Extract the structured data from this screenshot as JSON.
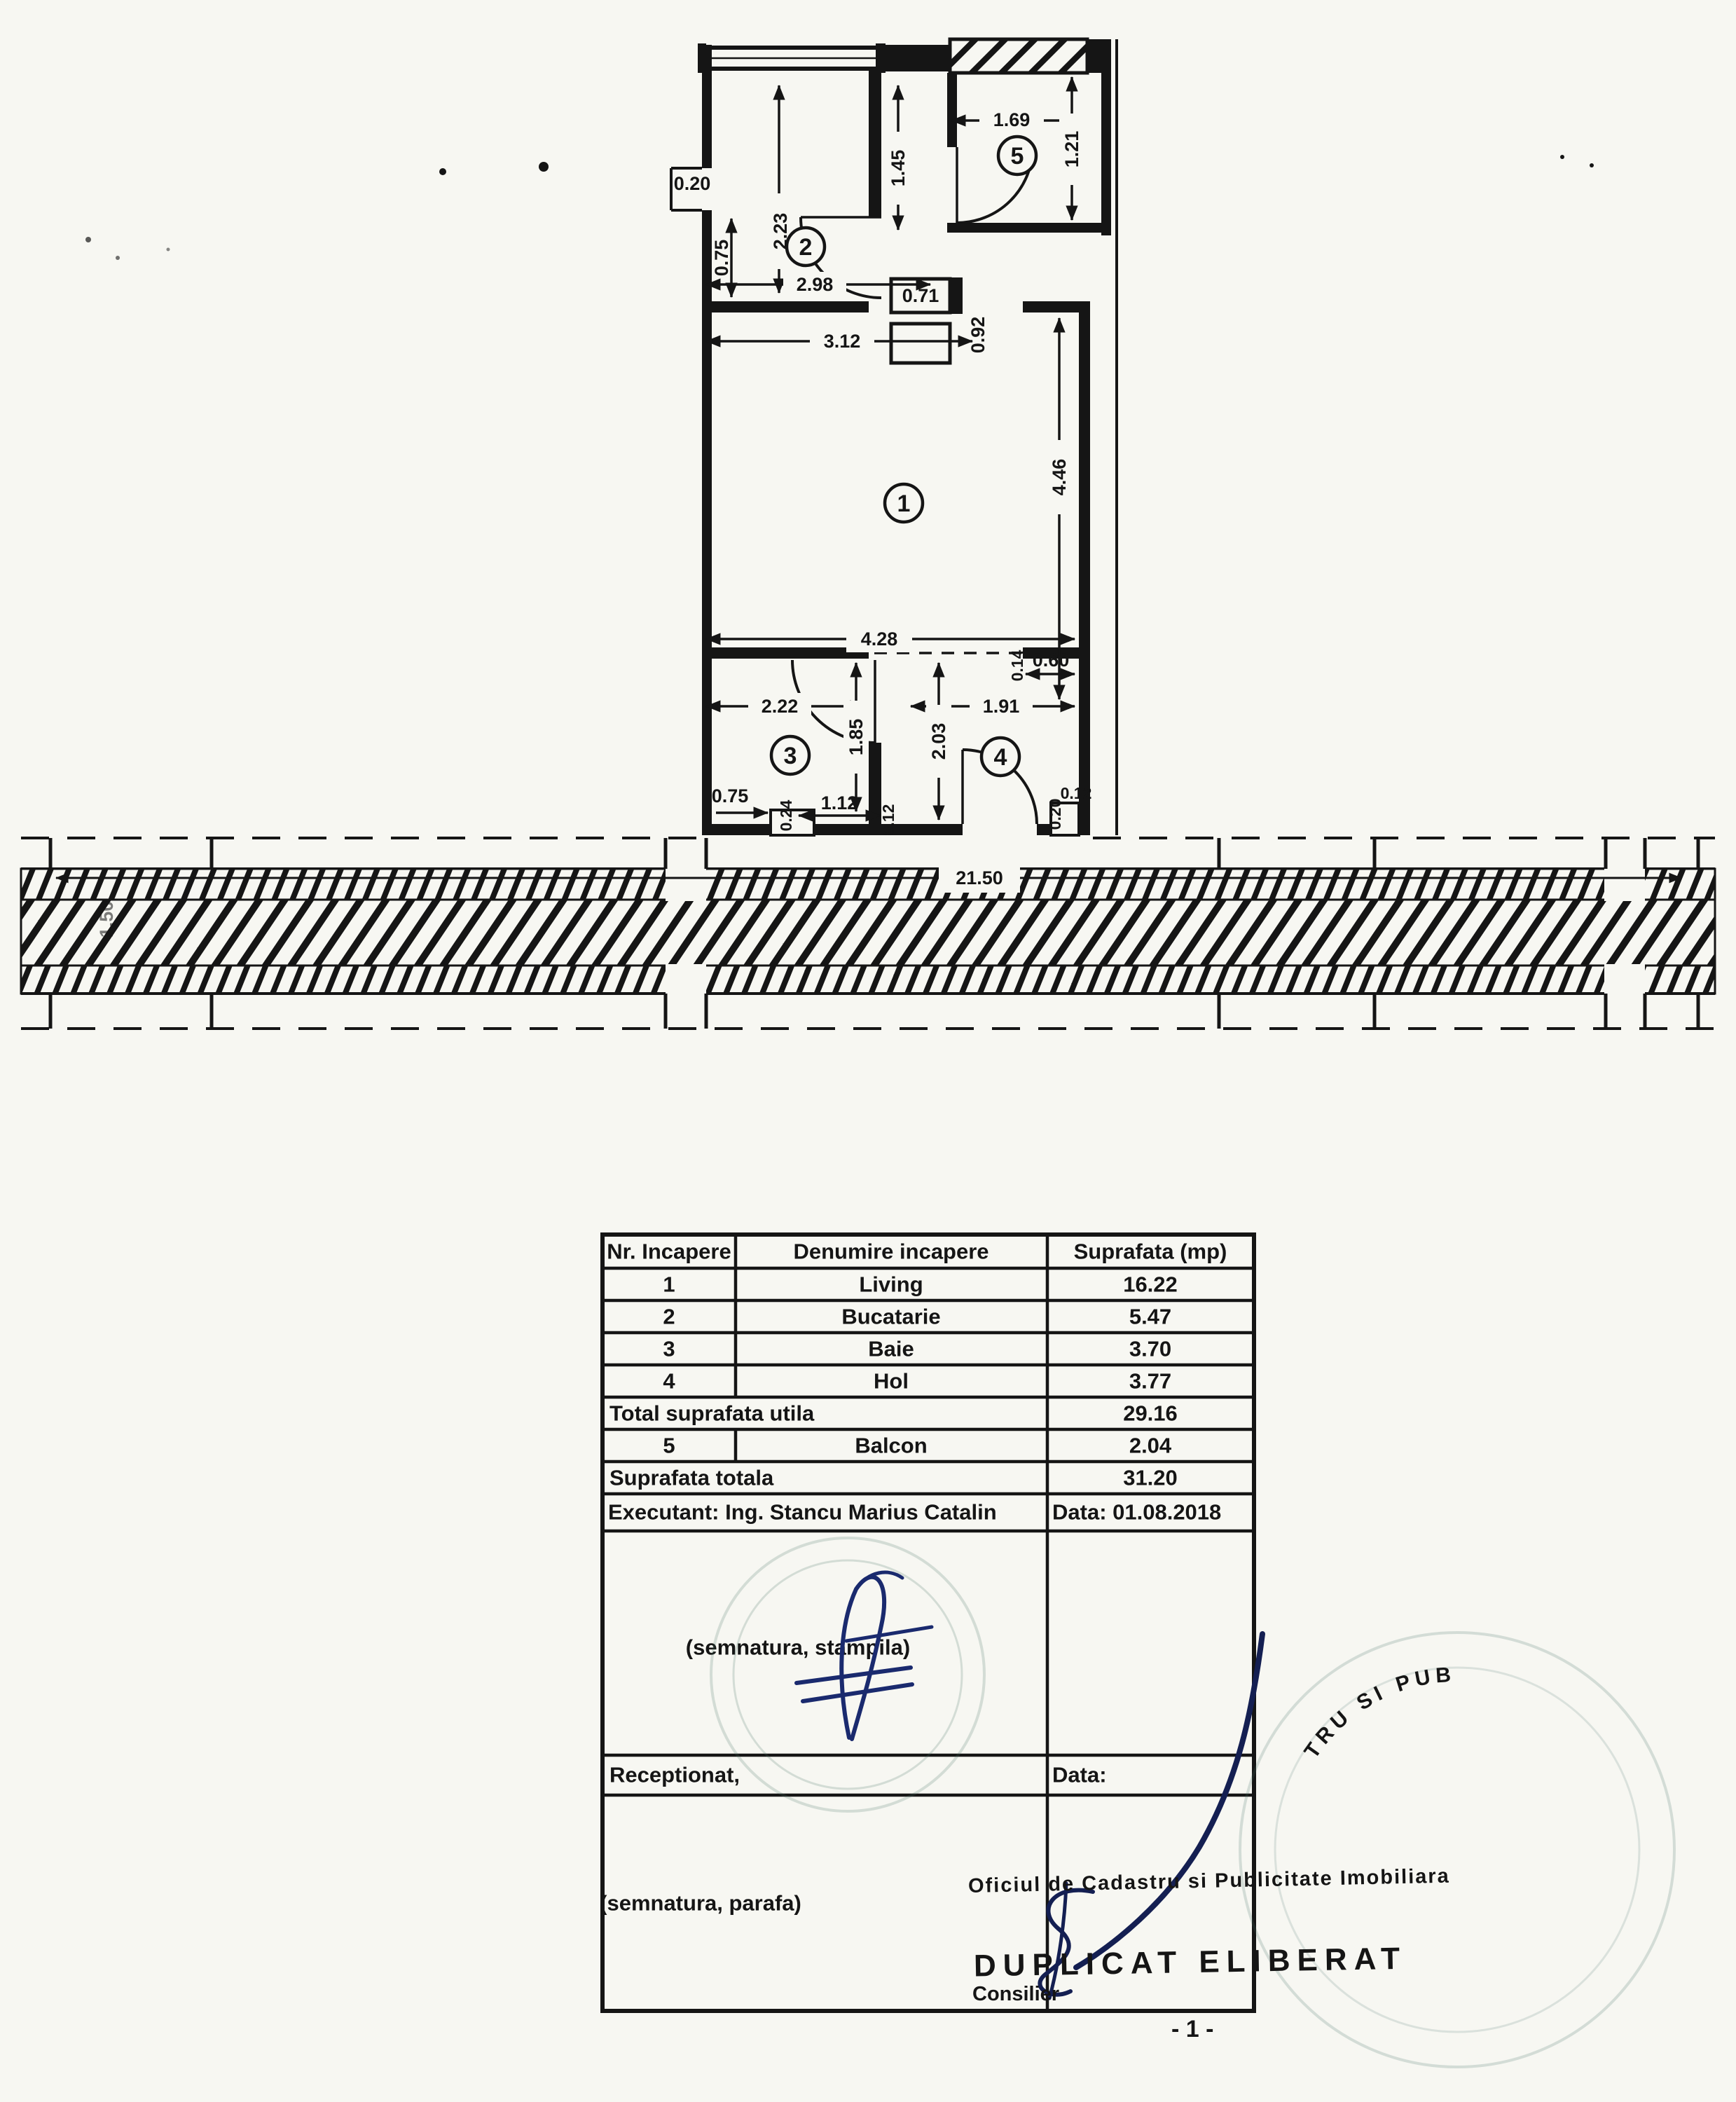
{
  "page": {
    "bg": "#f7f7f2",
    "ink": "#151515"
  },
  "plan": {
    "rooms": [
      {
        "num": "1"
      },
      {
        "num": "2"
      },
      {
        "num": "3"
      },
      {
        "num": "4"
      },
      {
        "num": "5"
      }
    ],
    "dims": {
      "k_notch": "0.20",
      "k_left": "0.75",
      "k_height": "2.23",
      "hall_h": "1.45",
      "k_width": "2.98",
      "jamb": "0.71",
      "balc_door": "0.92",
      "b_width": "1.69",
      "b_height": "1.21",
      "l_top": "3.12",
      "l_height": "4.46",
      "l_width": "4.28",
      "step": "0.14",
      "nib": "0.60",
      "baie_w": "2.22",
      "hol_w": "1.91",
      "baie_h": "1.85",
      "hol_h": "2.03",
      "bl_a": "0.75",
      "bl_b": "0.24",
      "bl_c": "1.12",
      "bl_d": "0.12",
      "br_a": "0.20",
      "br_b": "0.12",
      "corridor_len": "21.50",
      "corridor_w": "1.50"
    }
  },
  "table": {
    "headers": [
      "Nr. Incapere",
      "Denumire incapere",
      "Suprafata (mp)"
    ],
    "rows": [
      {
        "nr": "1",
        "name": "Living",
        "area": "16.22"
      },
      {
        "nr": "2",
        "name": "Bucatarie",
        "area": "5.47"
      },
      {
        "nr": "3",
        "name": "Baie",
        "area": "3.70"
      },
      {
        "nr": "4",
        "name": "Hol",
        "area": "3.77"
      }
    ],
    "total_utila": {
      "label": "Total suprafata utila",
      "value": "29.16"
    },
    "balcon": {
      "nr": "5",
      "name": "Balcon",
      "area": "2.04"
    },
    "total": {
      "label": "Suprafata totala",
      "value": "31.20"
    },
    "executant": "Executant: Ing. Stancu Marius Catalin",
    "date": "Data: 01.08.2018",
    "sig1_caption": "(semnatura, stampila)",
    "receptionat": "Receptionat,",
    "data_label": "Data:",
    "sig2_caption": "(semnatura, parafa)"
  },
  "annotations": {
    "office_line": "Oficiul de Cadastru si Publicitate Imobiliara",
    "duplicat": "DUPLICAT ELIBERAT",
    "consilier": "Consilier",
    "page_note": "- 1 -",
    "stamp_arc": "TRU SI PUB"
  }
}
